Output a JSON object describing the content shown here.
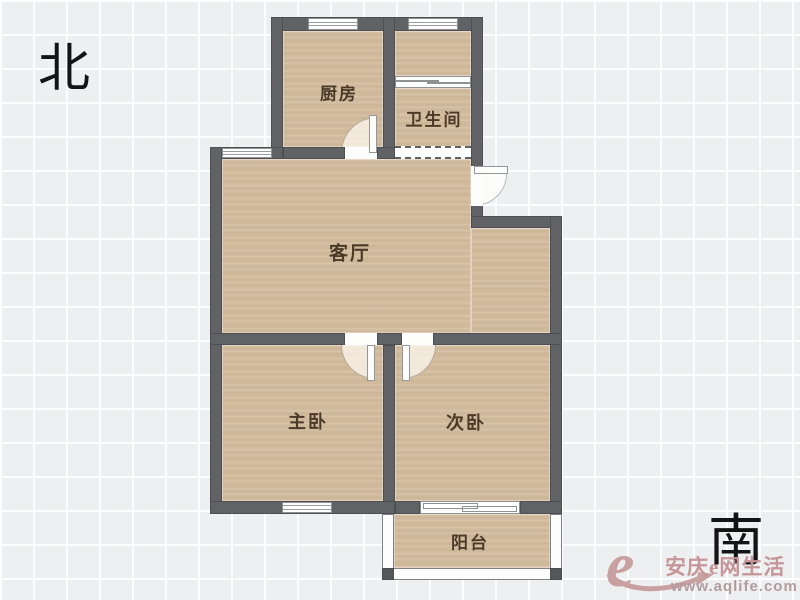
{
  "compass": {
    "north": "北",
    "south": "南"
  },
  "rooms": {
    "kitchen": {
      "label": "厨房"
    },
    "bathroom": {
      "label": "卫生间"
    },
    "living": {
      "label": "客厅"
    },
    "master": {
      "label": "主卧"
    },
    "second": {
      "label": "次卧"
    },
    "balcony": {
      "label": "阳台"
    }
  },
  "watermark": {
    "logo_letter": "e",
    "site_name": "安庆e网生活",
    "url": "www.aqlife.com"
  },
  "colors": {
    "wall": "#606265",
    "floor": "#d3bc9e",
    "background": "#edeff0",
    "label_text": "#4c3a28",
    "watermark": "#c59b9c"
  }
}
